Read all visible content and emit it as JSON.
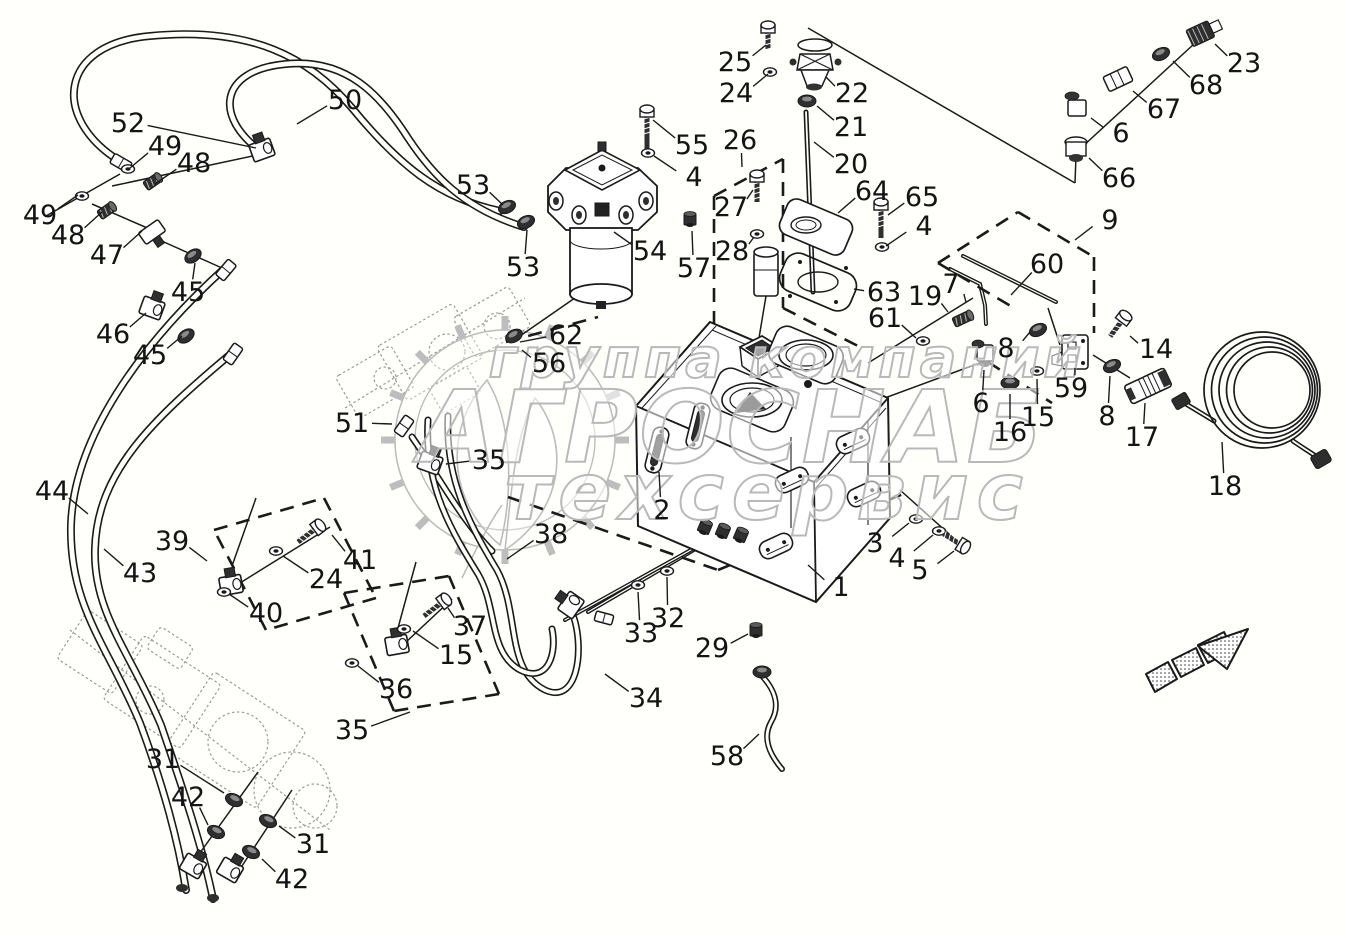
{
  "page": {
    "background": "#fffffb",
    "line_color": "#1a1a1a",
    "sketch_color": "#9a9a9a",
    "watermark_stroke": "#b9b9b9"
  },
  "watermark": {
    "line1": "группа компаний",
    "line2": "АГРОСНАБ",
    "line3": "техсервис"
  },
  "arrow": {
    "meaning": "direction-indicator",
    "direction": "up-right"
  },
  "callouts": [
    [
      "50",
      345,
      100,
      297,
      124
    ],
    [
      "52",
      128,
      123,
      256,
      148
    ],
    [
      "49",
      165,
      146,
      130,
      168
    ],
    [
      "48",
      194,
      163,
      155,
      184
    ],
    [
      "49",
      40,
      215,
      78,
      195
    ],
    [
      "48",
      68,
      235,
      102,
      212
    ],
    [
      "47",
      107,
      255,
      142,
      231
    ],
    [
      "45",
      188,
      292,
      195,
      263
    ],
    [
      "46",
      113,
      334,
      146,
      313
    ],
    [
      "45",
      150,
      355,
      182,
      336
    ],
    [
      "44",
      52,
      491,
      88,
      514
    ],
    [
      "43",
      140,
      573,
      104,
      549
    ],
    [
      "51",
      352,
      423,
      392,
      424
    ],
    [
      "39",
      172,
      541,
      207,
      561
    ],
    [
      "41",
      360,
      560,
      332,
      535
    ],
    [
      "24",
      326,
      579,
      283,
      556
    ],
    [
      "40",
      266,
      613,
      229,
      594
    ],
    [
      "37",
      470,
      626,
      448,
      608
    ],
    [
      "15",
      456,
      655,
      413,
      631
    ],
    [
      "36",
      396,
      689,
      358,
      666
    ],
    [
      "35",
      352,
      730,
      410,
      712
    ],
    [
      "35",
      489,
      460,
      446,
      464
    ],
    [
      "38",
      551,
      534,
      507,
      559
    ],
    [
      "62",
      566,
      335,
      520,
      342
    ],
    [
      "56",
      549,
      363,
      522,
      350
    ],
    [
      "53",
      473,
      185,
      503,
      205
    ],
    [
      "53",
      523,
      267,
      527,
      230
    ],
    [
      "54",
      650,
      251,
      614,
      232
    ],
    [
      "55",
      692,
      145,
      653,
      120
    ],
    [
      "4",
      694,
      177,
      654,
      156
    ],
    [
      "57",
      694,
      268,
      692,
      231
    ],
    [
      "25",
      735,
      62,
      766,
      45
    ],
    [
      "24",
      736,
      93,
      768,
      74
    ],
    [
      "22",
      852,
      93,
      826,
      77
    ],
    [
      "21",
      851,
      127,
      817,
      106
    ],
    [
      "20",
      851,
      164,
      814,
      142
    ],
    [
      "26",
      740,
      140,
      742,
      167
    ],
    [
      "27",
      731,
      207,
      753,
      190
    ],
    [
      "28",
      732,
      251,
      754,
      237
    ],
    [
      "64",
      872,
      191,
      838,
      213
    ],
    [
      "63",
      884,
      292,
      854,
      289
    ],
    [
      "65",
      922,
      197,
      888,
      215
    ],
    [
      "4",
      924,
      226,
      886,
      246
    ],
    [
      "9",
      1110,
      220,
      1075,
      240
    ],
    [
      "60",
      1047,
      264,
      1011,
      295
    ],
    [
      "7",
      951,
      284,
      966,
      302
    ],
    [
      "19",
      925,
      296,
      948,
      312
    ],
    [
      "61",
      885,
      318,
      916,
      338
    ],
    [
      "8",
      1006,
      348,
      1030,
      332
    ],
    [
      "14",
      1156,
      349,
      1130,
      336
    ],
    [
      "59",
      1071,
      388,
      1075,
      368
    ],
    [
      "6",
      981,
      403,
      984,
      370
    ],
    [
      "16",
      1010,
      432,
      1010,
      394
    ],
    [
      "15",
      1038,
      417,
      1037,
      379
    ],
    [
      "8",
      1107,
      416,
      1110,
      376
    ],
    [
      "17",
      1142,
      437,
      1145,
      403
    ],
    [
      "18",
      1225,
      486,
      1222,
      442
    ],
    [
      "23",
      1244,
      63,
      1215,
      44
    ],
    [
      "68",
      1206,
      85,
      1173,
      61
    ],
    [
      "67",
      1164,
      109,
      1133,
      91
    ],
    [
      "6",
      1121,
      133,
      1091,
      118
    ],
    [
      "66",
      1119,
      178,
      1089,
      158
    ],
    [
      "2",
      662,
      510,
      659,
      472
    ],
    [
      "1",
      841,
      587,
      808,
      565
    ],
    [
      "3",
      875,
      543,
      909,
      523
    ],
    [
      "4",
      897,
      558,
      933,
      535
    ],
    [
      "5",
      920,
      570,
      954,
      551
    ],
    [
      "32",
      668,
      618,
      667,
      577
    ],
    [
      "33",
      641,
      633,
      638,
      592
    ],
    [
      "29",
      712,
      648,
      748,
      634
    ],
    [
      "34",
      646,
      698,
      605,
      674
    ],
    [
      "58",
      727,
      756,
      759,
      734
    ],
    [
      "31",
      163,
      759,
      224,
      793
    ],
    [
      "42",
      188,
      797,
      208,
      825
    ],
    [
      "31",
      313,
      844,
      279,
      826
    ],
    [
      "42",
      292,
      879,
      262,
      859
    ]
  ]
}
